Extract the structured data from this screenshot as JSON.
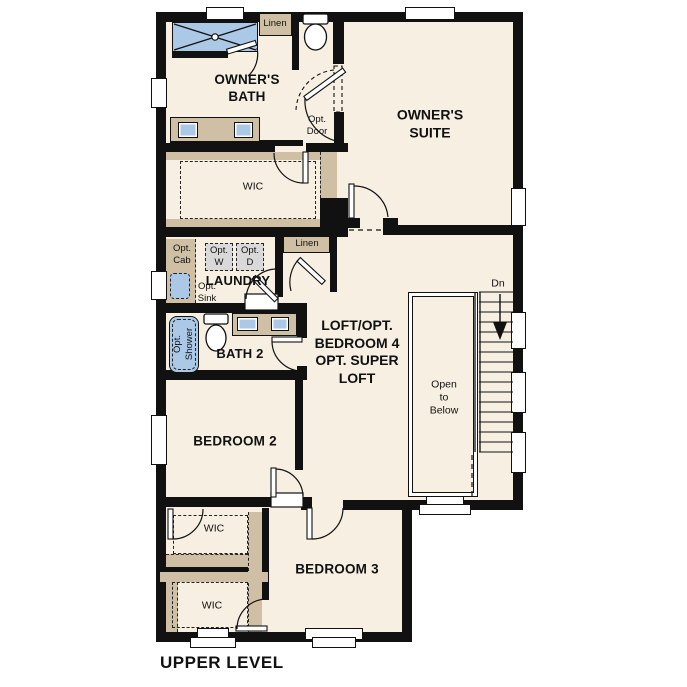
{
  "title": "UPPER LEVEL",
  "colors": {
    "floor": "#f6efe2",
    "wall": "#111111",
    "cabinet_tan": "#cfc0a5",
    "fixture_blue": "#abc8e6",
    "appliance_gray": "#d9d9d9",
    "window_white": "#ffffff"
  },
  "rooms": {
    "owners_bath": {
      "line1": "OWNER'S",
      "line2": "BATH"
    },
    "owners_suite": {
      "line1": "OWNER'S",
      "line2": "SUITE"
    },
    "wic_owner": {
      "label": "WIC"
    },
    "laundry": {
      "label": "LAUNDRY"
    },
    "bath2": {
      "label": "BATH 2"
    },
    "loft": {
      "line1": "LOFT/OPT.",
      "line2": "BEDROOM 4",
      "line3": "OPT. SUPER",
      "line4": "LOFT"
    },
    "bedroom2": {
      "label": "BEDROOM 2"
    },
    "bedroom3": {
      "label": "BEDROOM 3"
    },
    "wic_bedroom2": {
      "label": "WIC"
    },
    "wic_bedroom3": {
      "label": "WIC"
    },
    "open_to_below": {
      "line1": "Open",
      "line2": "to",
      "line3": "Below"
    }
  },
  "closets": {
    "linen_top": "Linen",
    "linen_hall": "Linen"
  },
  "options": {
    "opt_door": {
      "line1": "Opt.",
      "line2": "Door"
    },
    "opt_cab": {
      "line1": "Opt.",
      "line2": "Cab"
    },
    "opt_washer": {
      "line1": "Opt.",
      "line2": "W"
    },
    "opt_dryer": {
      "line1": "Opt.",
      "line2": "D"
    },
    "opt_sink": {
      "line1": "Opt.",
      "line2": "Sink"
    },
    "opt_shower": {
      "line1": "Opt.",
      "line2": "Shower"
    }
  },
  "stairs": {
    "down_label": "Dn"
  }
}
